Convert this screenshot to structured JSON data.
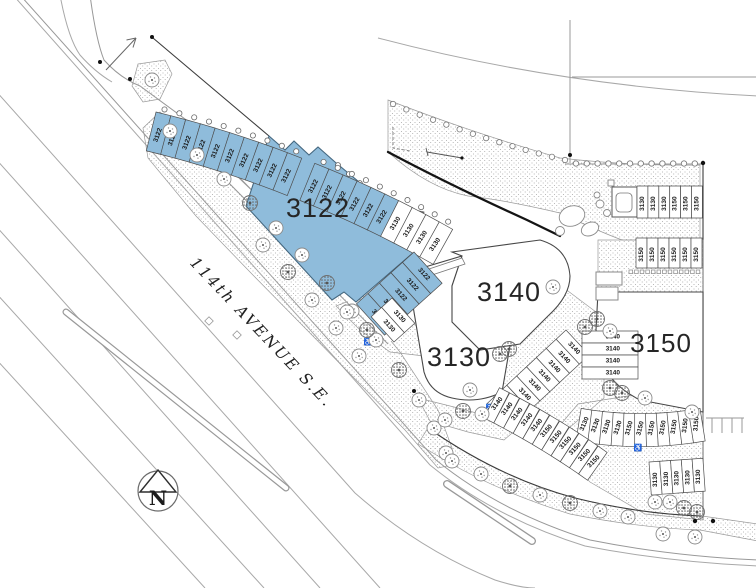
{
  "road": {
    "label": "114th AVENUE S.E."
  },
  "compass": {
    "label": "N"
  },
  "buildings": {
    "b3122": {
      "label": "3122",
      "highlighted": true
    },
    "b3130": {
      "label": "3130",
      "highlighted": false
    },
    "b3140": {
      "label": "3140",
      "highlighted": false
    },
    "b3150": {
      "label": "3150",
      "highlighted": false
    }
  },
  "colors": {
    "highlight": "#8FBCDB",
    "stall_outline": "#4d4d4d",
    "building_outline": "#474747",
    "road_line": "#a8a8a8",
    "boundary": "#141414",
    "stipple_dot": "#b0b0b0",
    "label_text": "#1a1a1a"
  },
  "stall_rows": {
    "top_arc": {
      "labels": [
        "3122",
        "3122",
        "3122",
        "3122",
        "3122",
        "3122",
        "3122",
        "3122",
        "3122",
        "3122",
        "3122",
        "3122",
        "3122",
        "3122",
        "3122",
        "3122",
        "3130",
        "3130",
        "3130",
        "3130"
      ],
      "gap_after_index": 9
    },
    "b3122_side": {
      "labels": [
        "3122",
        "3122",
        "3122",
        "3122",
        "3122"
      ],
      "accessible": true
    },
    "b3130_pair": {
      "labels": [
        "3130",
        "3130"
      ]
    },
    "diag_3140": {
      "labels": [
        "3140",
        "3140",
        "3140",
        "3140",
        "3140",
        "3140",
        "3140",
        "3140"
      ],
      "accessible": true
    },
    "col_3140": {
      "labels": [
        "3140",
        "3140",
        "3140",
        "3140"
      ]
    },
    "ne_upper": {
      "labels": [
        "3130",
        "3130",
        "3130",
        "3150",
        "3150",
        "3150"
      ]
    },
    "ne_lower": {
      "labels": [
        "3150",
        "3150",
        "3150",
        "3150",
        "3150",
        "3150"
      ]
    },
    "east_arc": {
      "labels": [
        "3130",
        "3130",
        "3130",
        "3130",
        "3150",
        "3150",
        "3150",
        "3150",
        "3150",
        "3150",
        "3150"
      ],
      "accessible": true
    },
    "south_arc": {
      "labels": [
        "3140",
        "3140",
        "3140",
        "3140",
        "3140",
        "3150",
        "3150",
        "3150",
        "3150",
        "3150",
        "3150"
      ]
    },
    "se_row": {
      "labels": [
        "3130",
        "3130",
        "3130",
        "3130",
        "3130"
      ]
    }
  }
}
